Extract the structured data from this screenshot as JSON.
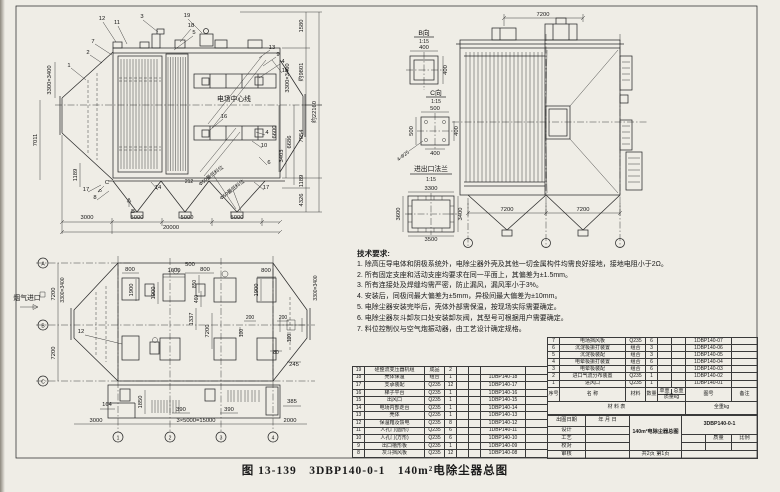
{
  "page": {
    "caption": "图 13-139　3DBP140-0-1　140m²电除尘器总图"
  },
  "side_view": {
    "callouts": [
      "1",
      "2",
      "3",
      "4",
      "5",
      "6",
      "7",
      "8",
      "9",
      "10",
      "11",
      "12",
      "13",
      "14",
      "15",
      "16",
      "17",
      "18",
      "19"
    ],
    "notes": {
      "center_line": "电场中心线",
      "min_level": "Φ50最低料位"
    },
    "view_labels": {
      "b": "B",
      "c": "C"
    },
    "dims": {
      "inlet_flange": "3300×3400",
      "left_7011": "7011",
      "left_1189": "1189",
      "b3000": "3000",
      "b5000a": "5000",
      "b5000b": "5000",
      "b5000c": "5000",
      "b20000": "20000",
      "r6600": "6600",
      "r3403": "3403",
      "r6686": "6686",
      "r7054": "7054",
      "r1189": "1189",
      "r4326": "4326",
      "r9801": "约9801",
      "r1580": "1580",
      "r_total": "约22160",
      "outlet_flange": "3300×3400",
      "neck212": "212"
    }
  },
  "front_view": {
    "dims": {
      "top7200": "7200",
      "bl7200": "7200",
      "br7200": "7200"
    },
    "details": {
      "b": {
        "title": "B向",
        "scale": "1:15",
        "w": "400",
        "h": "400"
      },
      "c": {
        "title": "C向",
        "scale": "1:15",
        "top": "500",
        "left": "500",
        "right": "400",
        "bottom": "400",
        "holes": "4-Φ25"
      },
      "flange": {
        "title": "进出口法兰",
        "scale": "1:15",
        "top": "3300",
        "left": "3600",
        "right": "3400",
        "bottom": "3500"
      }
    }
  },
  "plan_view": {
    "inlet": "烟气进口",
    "row_axes": [
      "A",
      "B",
      "C"
    ],
    "col_axes": [
      "1",
      "2",
      "3",
      "4"
    ],
    "callout": "12",
    "dims": {
      "d800a": "800",
      "d1600": "1600",
      "d500": "500",
      "d800b": "800",
      "d800c": "800",
      "d1900a": "1900",
      "d1900b": "1900",
      "d1900c": "1900",
      "d850": "850",
      "d460": "460",
      "d1337": "1337",
      "d7200v": "7200",
      "d200a": "200",
      "d200b": "200",
      "d100a": "100",
      "d100b": "100",
      "d80": "80",
      "d245": "245",
      "d164": "164",
      "d1850": "1850",
      "d390a": "390",
      "d390b": "390",
      "d385": "385",
      "d3000": "3000",
      "d15000": "3×5000=15000",
      "d2000": "2000",
      "left7200a": "7200",
      "left7200b": "7200",
      "flange_l": "3300×3400",
      "flange_r": "3300×3400"
    }
  },
  "tech": {
    "title": "技术要求:",
    "items": [
      "1. 除高压导电体和阴极系统外，电除尘器外壳及其他一切金属构件均需良好接地，接地电阻小于2Ω。",
      "2. 所有固定支座和活动支座均要求在同一平面上，其偏差为±1.5mm。",
      "3. 所有连接处及焊缝均需严密，防止漏风，漏风率小于3%。",
      "4. 安装后，同极间最大偏差为±5mm，异极间最大偏差为±10mm。",
      "5. 电除尘器安装完毕后，壳体外部需保温，按现场实际需要确定。",
      "6. 电除尘器灰斗卸灰口处安装卸灰阀，其型号可根据用户需要确定。",
      "7. 料位控制仪与空气炮振动器，由工艺设计确定规格。"
    ]
  },
  "parts": {
    "headers": {
      "no": "序号",
      "name": "名  称",
      "material": "材料",
      "qty": "数量",
      "unit": "单重",
      "total": "总重",
      "mass": "质量kg",
      "code": "图号",
      "remark": "备注"
    },
    "footer": {
      "material_list": "材  料  表",
      "total_weight": "全重kg"
    },
    "left_rows": [
      {
        "no": "19",
        "name": "硅整流变压器机组",
        "material": "成品",
        "qty": "2",
        "code": ""
      },
      {
        "no": "18",
        "name": "壳体保温",
        "material": "组合",
        "qty": "1",
        "code": "1DBP140-18"
      },
      {
        "no": "17",
        "name": "支承装配",
        "material": "Q235",
        "qty": "12",
        "code": "1DBP140-17"
      },
      {
        "no": "16",
        "name": "梯子平台",
        "material": "Q235",
        "qty": "1",
        "code": "1DBP140-16"
      },
      {
        "no": "15",
        "name": "出风口",
        "material": "Q235",
        "qty": "1",
        "code": "1DBP140-15"
      },
      {
        "no": "14",
        "name": "电场内部走台",
        "material": "Q235",
        "qty": "1",
        "code": "1DBP140-14"
      },
      {
        "no": "13",
        "name": "壳体",
        "material": "Q235",
        "qty": "1",
        "code": "1DBP140-13"
      },
      {
        "no": "12",
        "name": "保温箱及馈电",
        "material": "Q235",
        "qty": "8",
        "code": "1DBP140-12"
      },
      {
        "no": "11",
        "name": "人孔门(圆形)",
        "material": "Q235",
        "qty": "6",
        "code": "1DBP140-11"
      },
      {
        "no": "10",
        "name": "人孔门(方形)",
        "material": "Q235",
        "qty": "6",
        "code": "1DBP140-10"
      },
      {
        "no": "9",
        "name": "出口槽形板",
        "material": "Q235",
        "qty": "1",
        "code": "1DBP140-09"
      },
      {
        "no": "8",
        "name": "灰斗挡风板",
        "material": "Q235",
        "qty": "12",
        "code": "1DBP140-08"
      }
    ],
    "right_rows": [
      {
        "no": "7",
        "name": "电场挡风板",
        "material": "Q235",
        "qty": "6",
        "code": "1DBP140-07"
      },
      {
        "no": "6",
        "name": "沉淀极振打装置",
        "material": "组合",
        "qty": "3",
        "code": "1DBP140-06"
      },
      {
        "no": "5",
        "name": "沉淀极装配",
        "material": "组合",
        "qty": "3",
        "code": "1DBP140-05"
      },
      {
        "no": "4",
        "name": "电晕极振打装置",
        "material": "组合",
        "qty": "6",
        "code": "1DBP140-04"
      },
      {
        "no": "3",
        "name": "电晕极装配",
        "material": "组合",
        "qty": "6",
        "code": "1DBP140-03"
      },
      {
        "no": "2",
        "name": "进口气流分布装置",
        "material": "Q235",
        "qty": "1",
        "code": "1DBP140-02"
      },
      {
        "no": "1",
        "name": "进风口",
        "material": "Q235",
        "qty": "1",
        "code": "1DBP140-01"
      }
    ]
  },
  "title_block": {
    "date_label": "出图日期",
    "date_value": "年 月 日",
    "rows": [
      "设计",
      "工艺",
      "校对",
      "审核"
    ],
    "title": "140m²电除尘器总图",
    "drawing_no": "3DBP140-0-1",
    "mass": "质量",
    "scale": "比例",
    "pages": "共2页  第1页"
  }
}
